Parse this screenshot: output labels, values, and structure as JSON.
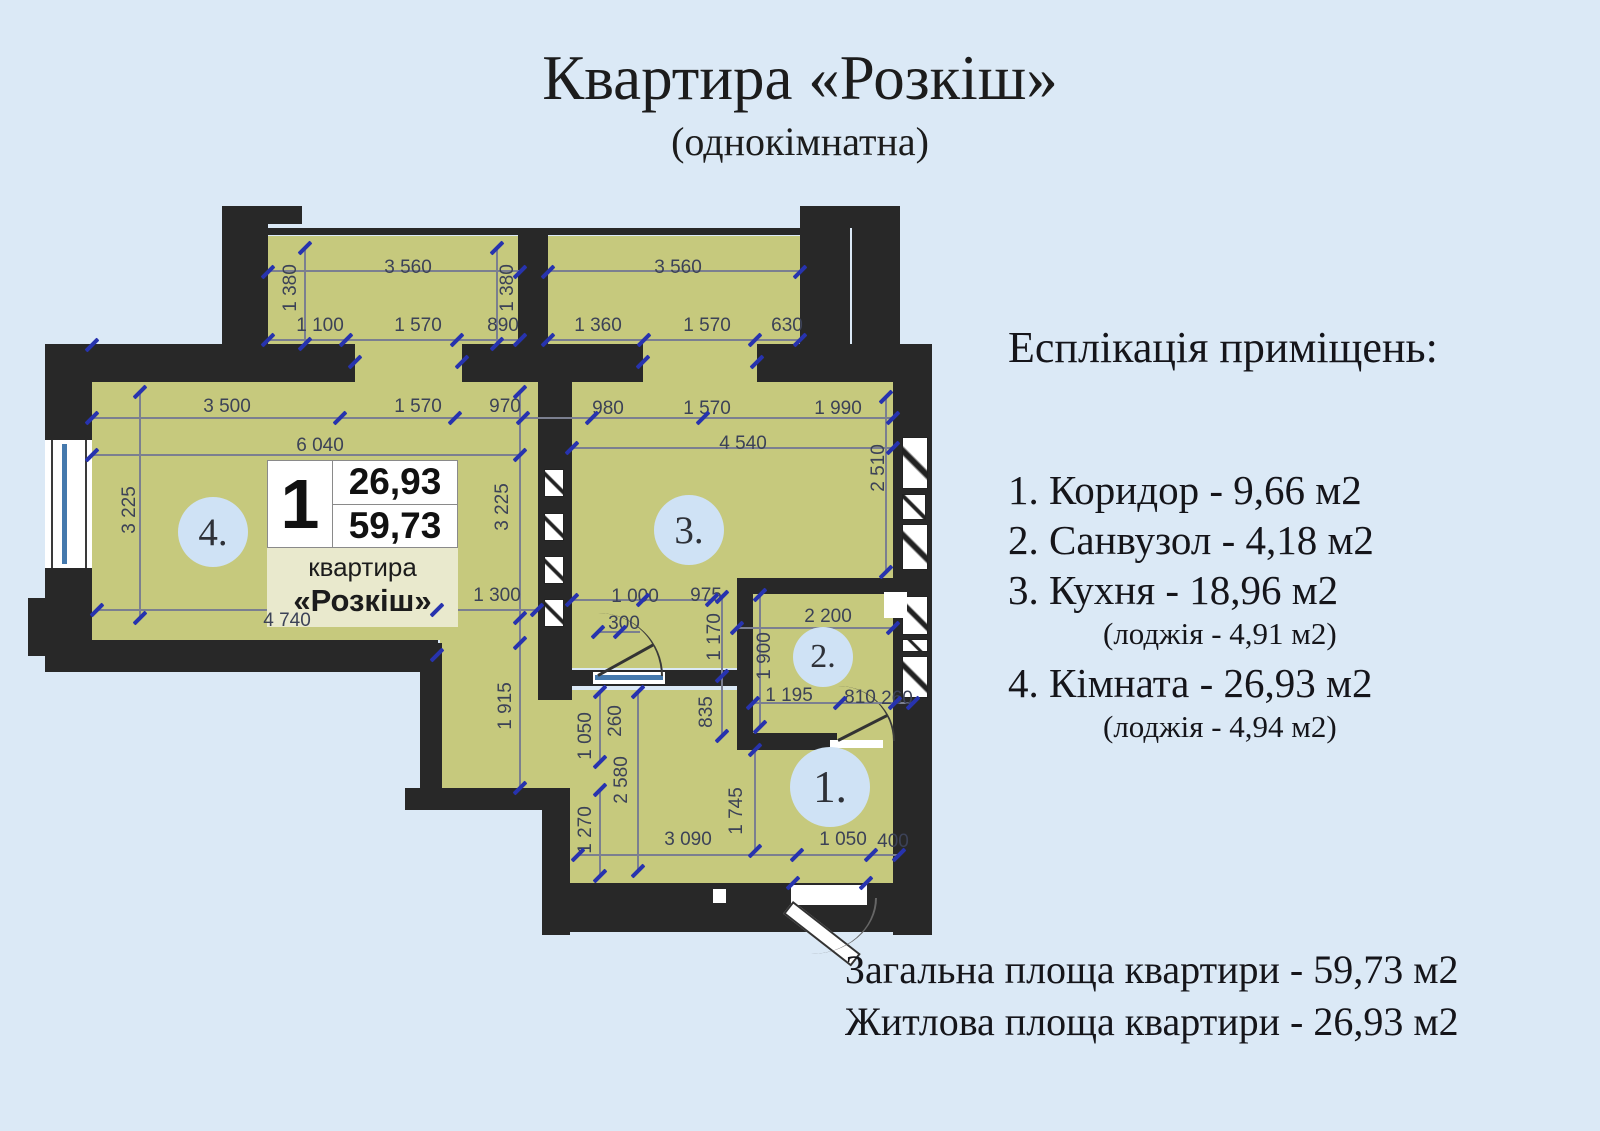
{
  "page": {
    "title": "Квартира «Розкіш»",
    "subtitle": "(однокімнатна)"
  },
  "explication": {
    "heading": "Есплікація приміщень:",
    "items": [
      {
        "text": "1. Коридор - 9,66 м2"
      },
      {
        "text": "2. Санвузол - 4,18 м2"
      },
      {
        "text": "3. Кухня - 18,96 м2",
        "sub": "(лоджія - 4,91 м2)"
      },
      {
        "text": "4. Кімната - 26,93 м2",
        "sub": "(лоджія - 4,94 м2)"
      }
    ]
  },
  "totals": [
    "Загальна площа квартири - 59,73 м2",
    "Житлова площа квартири - 26,93 м2"
  ],
  "info_card": {
    "flat_number": "1",
    "living_area": "26,93",
    "total_area": "59,73",
    "caption": "квартира",
    "name": "«Розкіш»"
  },
  "room_markers": [
    {
      "label": "4.",
      "x": 213,
      "y": 532,
      "d": 70
    },
    {
      "label": "3.",
      "x": 689,
      "y": 530,
      "d": 70
    },
    {
      "label": "2.",
      "x": 823,
      "y": 657,
      "d": 60
    },
    {
      "label": "1.",
      "x": 830,
      "y": 787,
      "d": 80
    }
  ],
  "dimensions": [
    {
      "t": "3 560",
      "x": 408,
      "y": 268,
      "v": 0
    },
    {
      "t": "1 380",
      "x": 291,
      "y": 288,
      "v": 1
    },
    {
      "t": "1 100",
      "x": 320,
      "y": 326,
      "v": 0
    },
    {
      "t": "1 570",
      "x": 418,
      "y": 326,
      "v": 0
    },
    {
      "t": "890",
      "x": 503,
      "y": 326,
      "v": 0
    },
    {
      "t": "1 380",
      "x": 508,
      "y": 288,
      "v": 1
    },
    {
      "t": "3 560",
      "x": 678,
      "y": 268,
      "v": 0
    },
    {
      "t": "1 360",
      "x": 598,
      "y": 326,
      "v": 0
    },
    {
      "t": "1 570",
      "x": 707,
      "y": 326,
      "v": 0
    },
    {
      "t": "630",
      "x": 787,
      "y": 326,
      "v": 0
    },
    {
      "t": "3 500",
      "x": 227,
      "y": 407,
      "v": 0
    },
    {
      "t": "1 570",
      "x": 418,
      "y": 407,
      "v": 0
    },
    {
      "t": "970",
      "x": 505,
      "y": 407,
      "v": 0
    },
    {
      "t": "980",
      "x": 608,
      "y": 409,
      "v": 0
    },
    {
      "t": "1 570",
      "x": 707,
      "y": 409,
      "v": 0
    },
    {
      "t": "1 990",
      "x": 838,
      "y": 409,
      "v": 0
    },
    {
      "t": "6 040",
      "x": 320,
      "y": 446,
      "v": 0
    },
    {
      "t": "4 540",
      "x": 743,
      "y": 444,
      "v": 0
    },
    {
      "t": "2 510",
      "x": 879,
      "y": 468,
      "v": 1
    },
    {
      "t": "3 225",
      "x": 130,
      "y": 510,
      "v": 1
    },
    {
      "t": "3 225",
      "x": 503,
      "y": 507,
      "v": 1
    },
    {
      "t": "1 300",
      "x": 497,
      "y": 596,
      "v": 0
    },
    {
      "t": "4 740",
      "x": 287,
      "y": 621,
      "v": 0
    },
    {
      "t": "1 915",
      "x": 506,
      "y": 706,
      "v": 1
    },
    {
      "t": "1 000",
      "x": 635,
      "y": 597,
      "v": 0
    },
    {
      "t": "975",
      "x": 706,
      "y": 596,
      "v": 0
    },
    {
      "t": "300",
      "x": 624,
      "y": 624,
      "v": 0
    },
    {
      "t": "1 170",
      "x": 715,
      "y": 637,
      "v": 1
    },
    {
      "t": "835",
      "x": 707,
      "y": 712,
      "v": 1
    },
    {
      "t": "2 200",
      "x": 828,
      "y": 617,
      "v": 0
    },
    {
      "t": "1 900",
      "x": 765,
      "y": 656,
      "v": 1
    },
    {
      "t": "1 195",
      "x": 789,
      "y": 696,
      "v": 0
    },
    {
      "t": "810",
      "x": 860,
      "y": 698,
      "v": 0
    },
    {
      "t": "260",
      "x": 897,
      "y": 699,
      "v": 0
    },
    {
      "t": "1 050",
      "x": 586,
      "y": 736,
      "v": 1
    },
    {
      "t": "260",
      "x": 616,
      "y": 721,
      "v": 1
    },
    {
      "t": "2 580",
      "x": 622,
      "y": 780,
      "v": 1
    },
    {
      "t": "1 270",
      "x": 586,
      "y": 830,
      "v": 1
    },
    {
      "t": "1 745",
      "x": 737,
      "y": 811,
      "v": 1
    },
    {
      "t": "3 090",
      "x": 688,
      "y": 840,
      "v": 0
    },
    {
      "t": "1 050",
      "x": 843,
      "y": 840,
      "v": 0
    },
    {
      "t": "400",
      "x": 893,
      "y": 842,
      "v": 0
    }
  ],
  "ticks": [
    [
      268,
      272
    ],
    [
      520,
      272
    ],
    [
      548,
      272
    ],
    [
      800,
      272
    ],
    [
      268,
      340
    ],
    [
      346,
      340
    ],
    [
      457,
      340
    ],
    [
      520,
      340
    ],
    [
      548,
      340
    ],
    [
      644,
      340
    ],
    [
      755,
      340
    ],
    [
      800,
      340
    ],
    [
      305,
      248
    ],
    [
      305,
      344
    ],
    [
      497,
      248
    ],
    [
      497,
      344
    ],
    [
      92,
      418
    ],
    [
      340,
      418
    ],
    [
      455,
      418
    ],
    [
      523,
      418
    ],
    [
      592,
      418
    ],
    [
      703,
      418
    ],
    [
      893,
      418
    ],
    [
      92,
      455
    ],
    [
      520,
      455
    ],
    [
      572,
      448
    ],
    [
      893,
      448
    ],
    [
      140,
      392
    ],
    [
      140,
      618
    ],
    [
      520,
      392
    ],
    [
      520,
      618
    ],
    [
      520,
      643
    ],
    [
      520,
      788
    ],
    [
      886,
      397
    ],
    [
      886,
      572
    ],
    [
      97,
      610
    ],
    [
      437,
      610
    ],
    [
      537,
      610
    ],
    [
      572,
      600
    ],
    [
      643,
      600
    ],
    [
      712,
      600
    ],
    [
      598,
      632
    ],
    [
      620,
      632
    ],
    [
      722,
      597
    ],
    [
      722,
      676
    ],
    [
      722,
      736
    ],
    [
      737,
      628
    ],
    [
      893,
      628
    ],
    [
      760,
      595
    ],
    [
      760,
      727
    ],
    [
      753,
      703
    ],
    [
      840,
      703
    ],
    [
      895,
      703
    ],
    [
      913,
      703
    ],
    [
      600,
      692
    ],
    [
      600,
      762
    ],
    [
      600,
      790
    ],
    [
      600,
      876
    ],
    [
      638,
      692
    ],
    [
      638,
      871
    ],
    [
      755,
      750
    ],
    [
      755,
      851
    ],
    [
      578,
      855
    ],
    [
      797,
      855
    ],
    [
      871,
      855
    ],
    [
      899,
      855
    ],
    [
      92,
      345
    ],
    [
      355,
      362
    ],
    [
      462,
      362
    ],
    [
      643,
      362
    ],
    [
      757,
      362
    ],
    [
      866,
      883
    ],
    [
      793,
      883
    ],
    [
      437,
      655
    ]
  ],
  "colors": {
    "background": "#dbe9f6",
    "room_fill": "#c6c97d",
    "wall": "#282828",
    "dim_text": "#3c4257",
    "tick_blue": "#2733ae",
    "marker_fill": "#cfe2f5",
    "card_beige": "#e9e9cd",
    "glass_blue": "#4579ad"
  }
}
